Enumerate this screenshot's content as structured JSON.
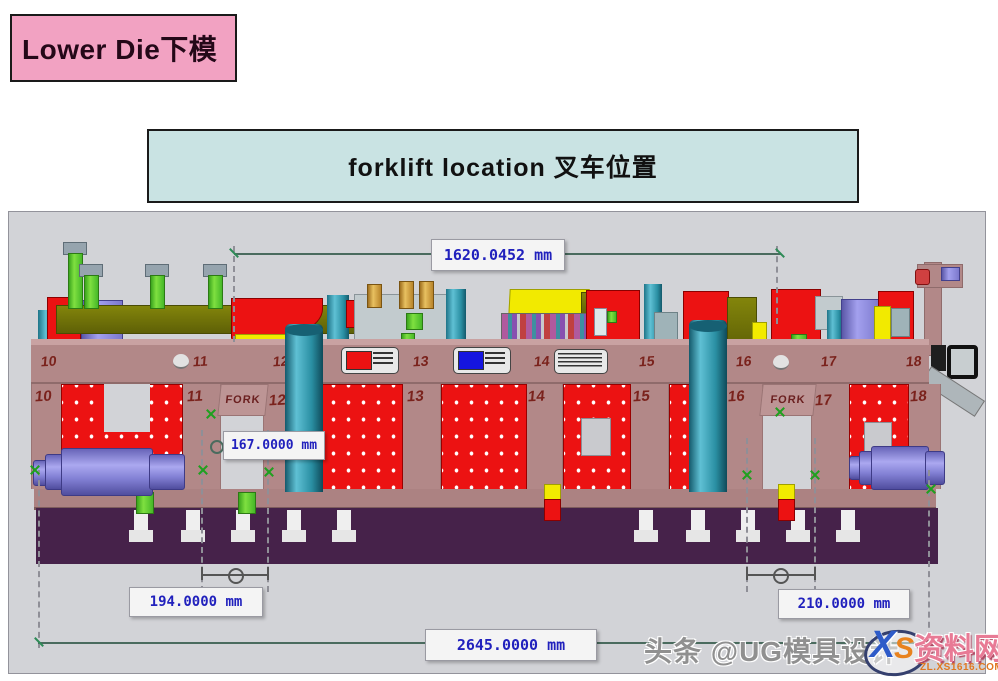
{
  "banners": {
    "title": "Lower Die下模",
    "subtitle": "forklift  location  叉车位置"
  },
  "diagram": {
    "beam_numbers": [
      "10",
      "11",
      "12",
      "13",
      "14",
      "15",
      "16",
      "17",
      "18"
    ],
    "leg_numbers": [
      "10",
      "11",
      "12",
      "13",
      "14",
      "15",
      "16",
      "17",
      "18"
    ],
    "fork_labels": [
      "FORK",
      "FORK"
    ],
    "dimensions": {
      "top_width": "1620.0452 mm",
      "fork_pocket": "167.0000 mm",
      "left_fork_span": "194.0000 mm",
      "right_fork_span": "210.0000 mm",
      "total_length": "2645.0000 mm"
    },
    "colors": {
      "die_plate": "#b28888",
      "insert_red": "#ec1212",
      "cylinder_teal": "#2f98ae",
      "base_slab": "#46224a",
      "dimension_text": "#2121bd"
    }
  },
  "watermark": {
    "credit": "头条 @UG模具设计",
    "logo_x": "X",
    "logo_s": "S",
    "logo_name": "资料网",
    "logo_domain": "ZL.XS1616.COM"
  }
}
